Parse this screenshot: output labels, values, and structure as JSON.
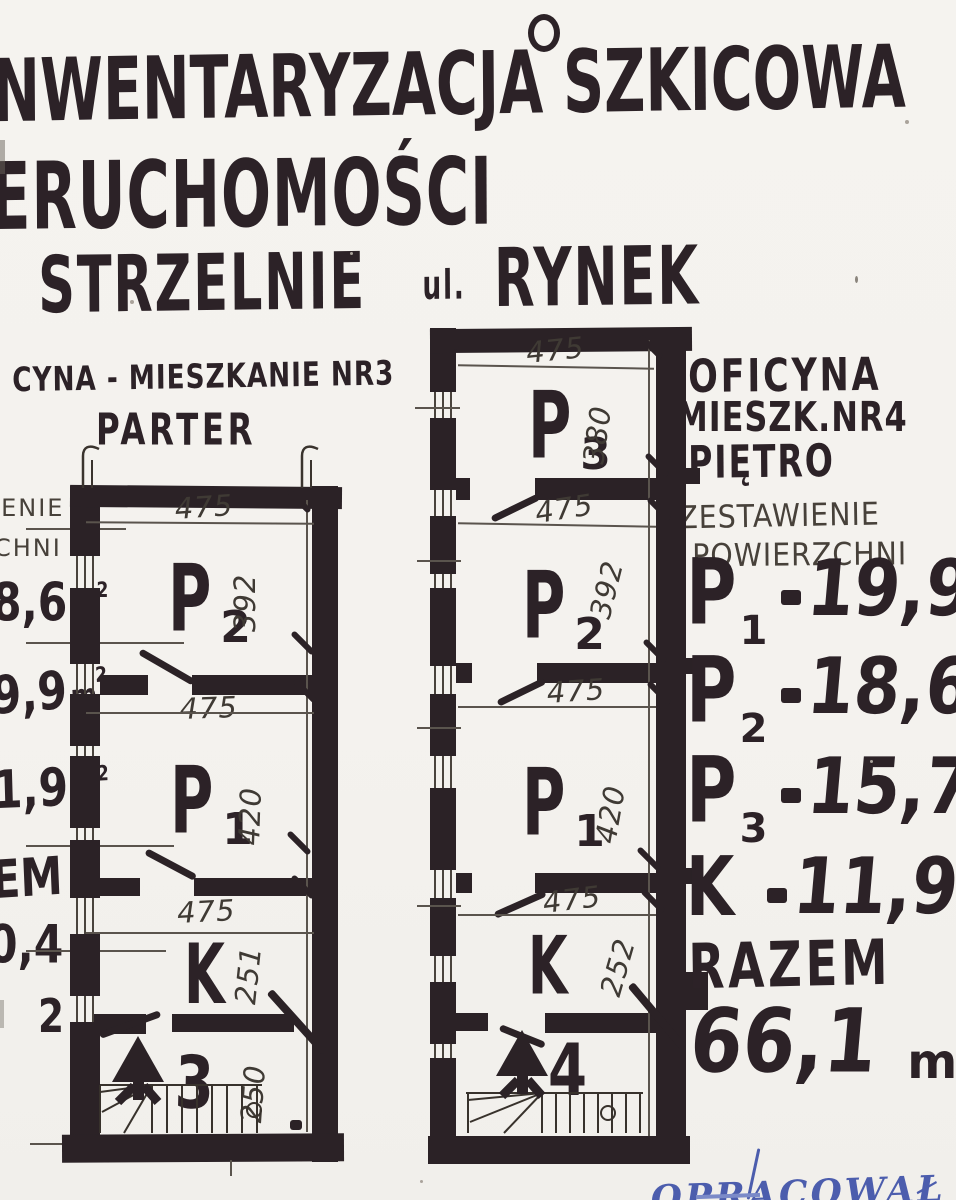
{
  "title": {
    "line1": "NWENTARYZACJA SZKICOWA",
    "line2": "ERUCHOMOŚCI",
    "line3a": "STRZELNIE",
    "line3b": "ul.",
    "line3c": "RYNEK"
  },
  "planA": {
    "heading1": "CYNA - MIESZKANIE NR3",
    "heading2": "PARTER",
    "unit_number": "3",
    "rooms": [
      {
        "label": "P",
        "sub": "2"
      },
      {
        "label": "P",
        "sub": "1"
      },
      {
        "label": "K",
        "sub": ""
      }
    ],
    "dims": {
      "top": "475",
      "p2_h": "392",
      "mid1": "475",
      "p1_h": "420",
      "mid2": "475",
      "k_h": "251",
      "stair_h": "250"
    }
  },
  "planB": {
    "heading1": "OFICYNA",
    "heading2": "MIESZK.NR4",
    "heading3": "PIĘTRO",
    "unit_number": "4",
    "rooms": [
      {
        "label": "P",
        "sub": "3"
      },
      {
        "label": "P",
        "sub": "2"
      },
      {
        "label": "P",
        "sub": "1"
      },
      {
        "label": "K",
        "sub": ""
      }
    ],
    "dims": {
      "top": "475",
      "p3_h": "380",
      "mid1": "475",
      "p2_h": "392",
      "mid2": "475",
      "p1_h": "420",
      "mid3": "475",
      "k_h": "252"
    }
  },
  "left_margin": {
    "fragments": [
      {
        "text": "IENIE"
      },
      {
        "text": "CHNI"
      },
      {
        "text": "8,6",
        "unit": "m",
        "sup": "2"
      },
      {
        "text": "9,9",
        "unit": "m",
        "sup": "2"
      },
      {
        "text": "1,9",
        "unit": "m",
        "sup": "2"
      },
      {
        "text": "EM"
      },
      {
        "text": "0,4"
      },
      {
        "text": "2"
      }
    ]
  },
  "summary": {
    "heading1": "ZESTAWIENIE",
    "heading2": "POWIERZCHNI",
    "rows": [
      {
        "label": "P",
        "sub": "1",
        "value": "19,9",
        "unit": "m",
        "sup": "2"
      },
      {
        "label": "P",
        "sub": "2",
        "value": "18,6",
        "unit": "m",
        "sup": "2"
      },
      {
        "label": "P",
        "sub": "3",
        "value": "15,7",
        "unit": "m",
        "sup": "2"
      },
      {
        "label": "K",
        "sub": "",
        "value": "11,9",
        "unit": "m",
        "sup": "2"
      }
    ],
    "total_label": "RAZEM",
    "total_value": "66,1",
    "total_unit": "m",
    "total_sup": "2"
  },
  "signature": {
    "text": "OPRACOWAŁ"
  },
  "colors": {
    "ink": "#2b2226",
    "pencil": "#47413a",
    "paper": "#f4f2ee",
    "blue": "#4c5dad"
  }
}
